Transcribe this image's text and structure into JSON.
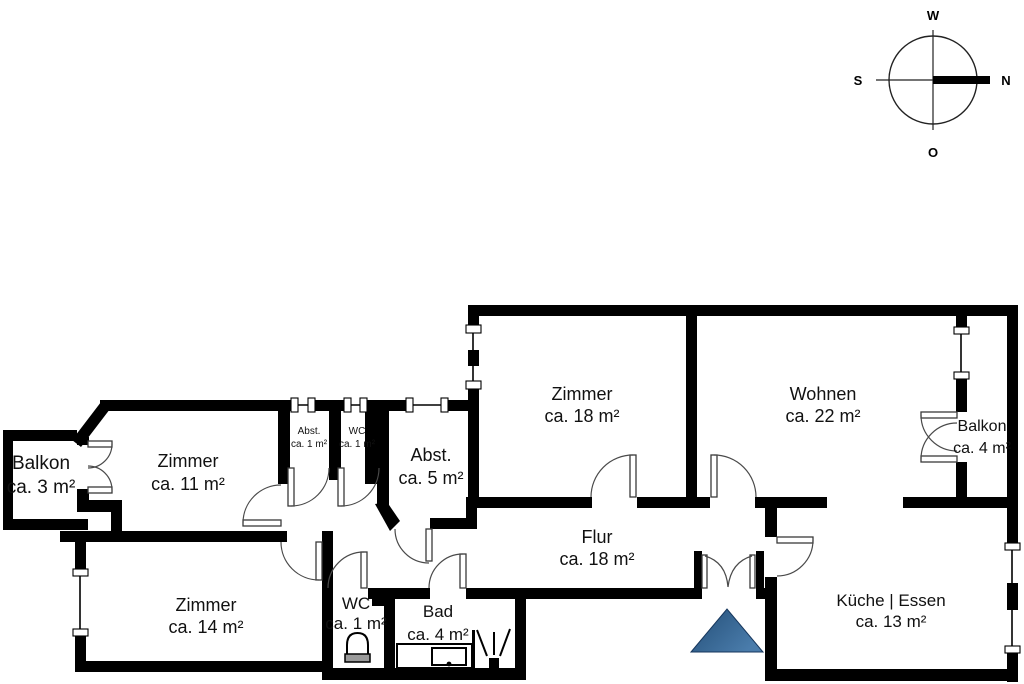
{
  "compass": {
    "top": "W",
    "right": "N",
    "left": "S",
    "bottom": "O"
  },
  "rooms": [
    {
      "id": "balkon-links",
      "name": "Balkon",
      "area": "ca. 3 m²"
    },
    {
      "id": "zimmer-11",
      "name": "Zimmer",
      "area": "ca. 11 m²"
    },
    {
      "id": "abst-1",
      "name": "Abst.",
      "area": "ca. 1 m²"
    },
    {
      "id": "wc-oben",
      "name": "WC",
      "area": "ca. 1 m²"
    },
    {
      "id": "abst-5",
      "name": "Abst.",
      "area": "ca. 5 m²"
    },
    {
      "id": "zimmer-18",
      "name": "Zimmer",
      "area": "ca. 18 m²"
    },
    {
      "id": "wohnen",
      "name": "Wohnen",
      "area": "ca. 22 m²"
    },
    {
      "id": "balkon-rechts",
      "name": "Balkon",
      "area": "ca. 4 m²"
    },
    {
      "id": "flur",
      "name": "Flur",
      "area": "ca. 18 m²"
    },
    {
      "id": "zimmer-14",
      "name": "Zimmer",
      "area": "ca. 14 m²"
    },
    {
      "id": "wc-unten",
      "name": "WC",
      "area": "ca. 1 m²"
    },
    {
      "id": "bad",
      "name": "Bad",
      "area": "ca. 4 m²"
    },
    {
      "id": "kueche",
      "name": "Küche | Essen",
      "area": "ca. 13 m²"
    }
  ],
  "colors": {
    "wall": "#000000",
    "entrance_marker_dark": "#1f4a72",
    "entrance_marker_light": "#4a7cab"
  }
}
